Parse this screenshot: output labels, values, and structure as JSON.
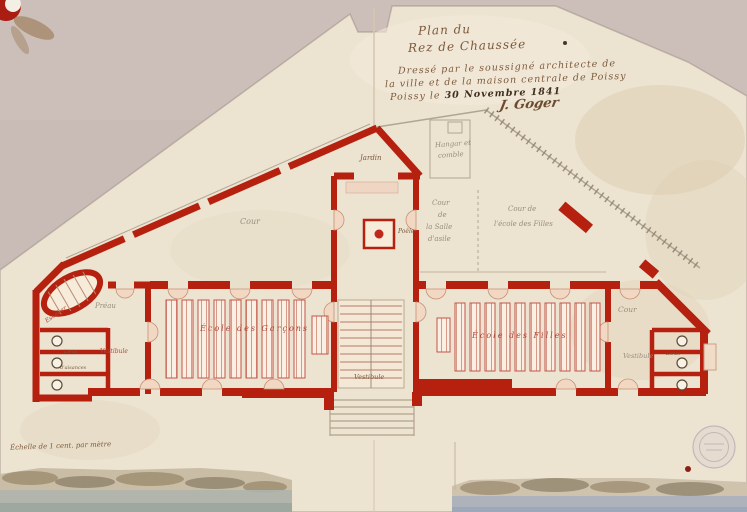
{
  "document": {
    "type": "scanned architectural floor plan, Poissy schools, 1841",
    "title_block": {
      "line1": "Plan du",
      "line2": "Rez de Chaussée",
      "line3": "Dressé par le soussigné architecte de",
      "line4": "la ville et de la maison centrale de Poissy",
      "date_prefix": "Poissy le ",
      "date": "30 Novembre 1841",
      "signature": "J. Goger"
    },
    "scale_note": "Échelle de 1 cent. par mètre"
  },
  "labels": {
    "cour_left": "Cour",
    "gable_room": "Jardin",
    "hangar_line1": "Hangar et",
    "hangar_line2": "comble",
    "cour_asile_l1": "Cour",
    "cour_asile_l2": "de",
    "cour_asile_l3": "la Salle",
    "cour_asile_l4": "d'asile",
    "cour_filles_l1": "Cour de",
    "cour_filles_l2": "l'école des Filles",
    "poele": "Poêle",
    "vestibule_center": "Vestibule",
    "ecole_garcons": "École des Garçons",
    "ecole_filles": "École des Filles",
    "preau": "Préau",
    "escalier": "Escalier",
    "vestibule_left": "Vestibule",
    "lieux_left": "Lieux",
    "aisances_left": "d'aisances",
    "cour_right": "Cour",
    "vestibule_right": "Vestibule",
    "lieux_right": "Lieux"
  },
  "colors": {
    "wall_red": "#b5200f",
    "paper": "#ece3d1",
    "mat_gray": "#c6b9b3",
    "ink_sepia": "#7d5a3c",
    "pencil_gray": "#9a8d7c",
    "bench_pink": "#f9efe2",
    "wash_blue": "#a8b0bd"
  }
}
